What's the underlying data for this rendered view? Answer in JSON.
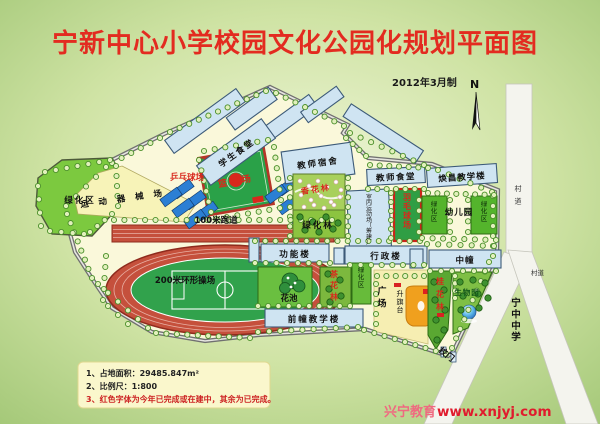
{
  "header": {
    "title": "宁新中心小学校园文化公园化规划平面图",
    "date_note": "2012年3月制",
    "compass_north": "N"
  },
  "labels": {
    "student_canteen": "学生食堂",
    "teacher_dorm": "教师宿舍",
    "basketball_court": "篮球场",
    "pingpong_court": "乒乓球场",
    "equipment_field": "运动器械场",
    "track_100m": "100米跑道",
    "track_200m": "200米环形操场",
    "green_zone_west": "绿化区",
    "fragrant_flower_forest": "香花林",
    "green_forest": "绿化林",
    "teacher_canteen": "教师食堂",
    "huanchang_teaching_building": "焕昌教学楼",
    "indoor_stadium": "室内运动场（筹建）",
    "badminton_court": "羽毛球场",
    "green_zone_kindergarten_left": "绿化区",
    "green_zone_kindergarten_right": "绿化区",
    "kindergarten": "幼儿园",
    "function_building": "功能楼",
    "admin_building": "行政楼",
    "middle_building": "中幢",
    "flower_pool": "花池",
    "camellia_forest": "茶花林",
    "green_zone_mid": "绿化区",
    "plaza": "广场",
    "flag_platform": "升旗台",
    "osmanthus_forest": "桂花林",
    "biology_garden": "生物园",
    "front_teaching_building": "前幢教学楼",
    "school_gate": "校门",
    "ningzhong_middle_school": "宁中中学",
    "village_road_right": "村道",
    "village_road_bend": "村道"
  },
  "legend": {
    "line_1": "1、占地面积：29485.847m²",
    "line_2": "2、比例尺：1:800",
    "line_3": "3、红色字体为今年已完成或在建中，其余为已完成。"
  },
  "watermark": {
    "brand": "兴宁教育",
    "site": "www.xnjyj.com"
  },
  "colors": {
    "title_red": "#e32b20",
    "label_red": "#d8281c",
    "building_blue": "#cfe4f2",
    "court_green": "#2aa148",
    "track_red": "#c5503c",
    "campus_cream": "#faf8da",
    "green_area": "#7cc93f",
    "road_white": "#f4f4ee",
    "legend_bg": "#faf7cc"
  }
}
